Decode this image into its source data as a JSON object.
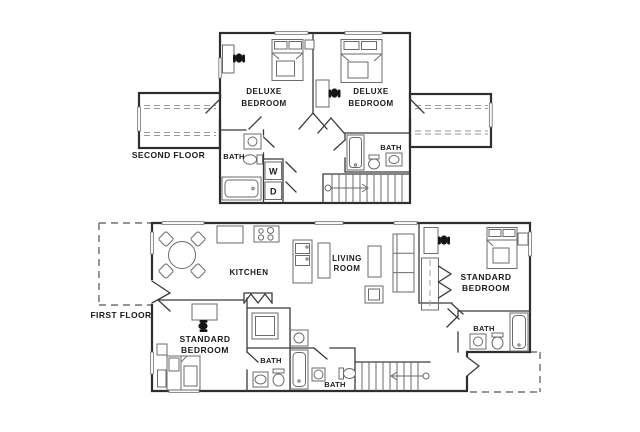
{
  "floorplan": {
    "colors": {
      "wall_line": "#2e2e2e",
      "fixture_line": "#6b6b6b",
      "text": "#1b1b1b",
      "background": "#ffffff"
    },
    "second_floor": {
      "label": "SECOND FLOOR",
      "bedroom_left": {
        "line1": "DELUXE",
        "line2": "BEDROOM"
      },
      "bedroom_right": {
        "line1": "DELUXE",
        "line2": "BEDROOM"
      },
      "bath_left": "BATH",
      "bath_right": "BATH",
      "washer": "W",
      "dryer": "D"
    },
    "first_floor": {
      "label": "FIRST FLOOR",
      "kitchen": "KITCHEN",
      "living_room": {
        "line1": "LIVING",
        "line2": "ROOM"
      },
      "bedroom_left": {
        "line1": "STANDARD",
        "line2": "BEDROOM"
      },
      "bedroom_right": {
        "line1": "STANDARD",
        "line2": "BEDROOM"
      },
      "bath_left": "BATH",
      "bath_center": "BATH",
      "bath_right": "BATH"
    }
  }
}
